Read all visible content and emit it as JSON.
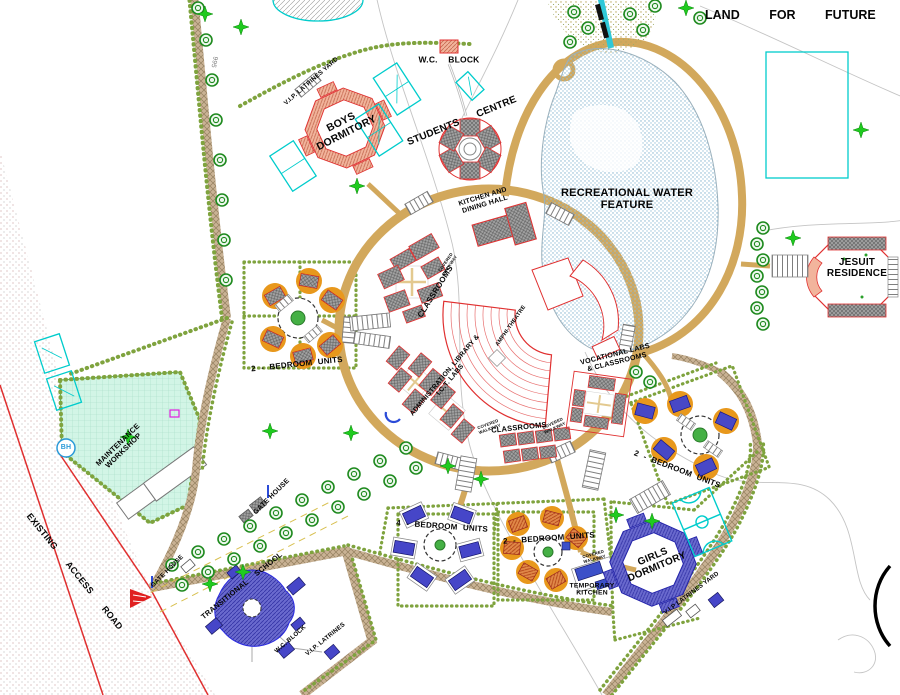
{
  "drawing": {
    "type": "campus-master-site-plan",
    "labels": {
      "land_future": "LAND FOR FUTURE DE",
      "wc_block_top": "W.C. BLOCK",
      "vip_latrines_top": "V.I.P. LATRINES YARD",
      "boys_dormitory": "BOYS\nDORMITORY",
      "students_centre": "STUDENTS CENTRE",
      "recreational_water": "RECREATIONAL WATER\nFEATURE",
      "kitchen_dining": "KITCHEN AND\nDINING HALL",
      "covered_walkway": "COVERED\nWALKWAY",
      "classrooms_west": "CLASSROOMS",
      "amphi_theatre": "AMPHI-THEATRE",
      "admin_library": "ADMINISTRATION, LIBRARY &\nI.C.T. LABS",
      "classrooms_south": "CLASSROOMS",
      "vocational": "VOCATIONAL LABS\n& CLASSROOMS",
      "jesuit_residence": "JESUIT\nRESIDENCE",
      "bedroom2_west": "2 - BEDROOM UNITS",
      "bedroom2_east": "2 - BEDROOM UNITS",
      "bedroom2_south": "2 - BEDROOM UNITS",
      "bedroom4": "4 - BEDROOM UNITS",
      "temporary_kitchen": "TEMPORARY\nKITCHEN",
      "girls_dormitory": "GIRLS\nDORMITORY",
      "vip_latrines_yard_se": "V.I.P LATRINES YARD",
      "maintenance_workshop": "MAINTENANCE\nWORKSHOP",
      "gate_house_mid": "GATE HOUSE",
      "gate_house_sw": "GATE HOUSE",
      "existing_access_road": "EXISTING ACCESS ROAD",
      "transitional_school": "TRANSITIONAL SCHOOL",
      "wc_block_south": "W.C. BLOCK",
      "vip_latrines_south": "V.I.P. LATRINES",
      "borehole": "BH",
      "contour_995": "995"
    },
    "colors": {
      "road_tan": "#d2a85c",
      "road_hatch": "#c9b294",
      "hedge_green": "#7fa33e",
      "water_stipple": "#7fb0cc",
      "building_outline_red": "#e03030",
      "roof_gray": "#a0a0a0",
      "dorm_salmon": "#f2b49c",
      "dorm_blue": "#6a6ace",
      "apron_orange": "#e8981c",
      "mint_field": "#d2f5e6",
      "court_cyan": "#00cccc",
      "tree_green": "#1f8a1f",
      "palm_green": "#1fca1f",
      "marker_red": "#e02020",
      "borehole_blue": "#2a9ad8"
    }
  }
}
